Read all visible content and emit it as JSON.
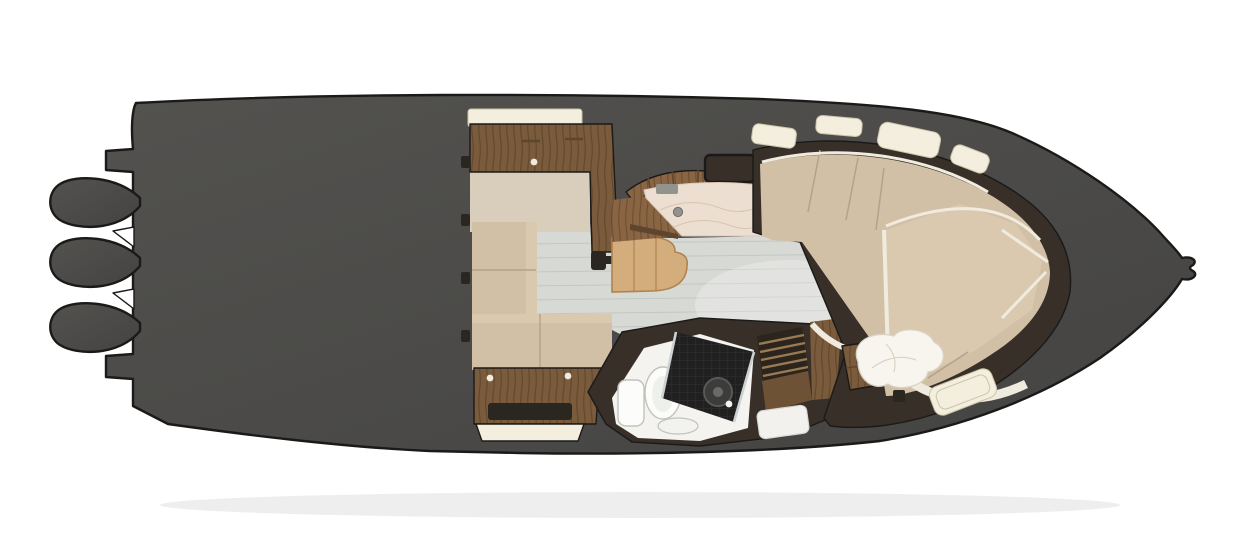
{
  "meta": {
    "diagram_type": "boat-interior-floor-plan-top-view",
    "orientation": "bow-right-stern-left"
  },
  "counts": {
    "engine_pods": 3,
    "top_deck_hatches": 4,
    "bow_lower_hatches": 1,
    "pillows": 2
  },
  "regions": {
    "hull": "boat hull top view",
    "engines": "triple outboard engine pods at stern",
    "salon_cabinet": "salon cabinet with cream counter trim",
    "settee": "L-shaped settee with tan cushions",
    "galley": "galley cabinet with dark sink slot",
    "table": "wood dinette table with pedestal mount",
    "steps": "curved companionway steps",
    "counter": "marble galley countertop with sink and faucet",
    "head": "wet head compartment",
    "toilet": "toilet with tank",
    "shower": "mosaic tile shower floor with drain",
    "grate": "teak shower grate",
    "floor": "cabin sole with plank lines",
    "bow_seating": "wraparound bow seating cushions",
    "berth": "forward berth cushion",
    "pillows": "white berth pillows",
    "hatches": "cream deck hatches",
    "anchor": "anchor roller notch at bow tip"
  },
  "colors": {
    "background": "#ffffff",
    "hull_top": "#53524f",
    "hull_bottom": "#444342",
    "outline": "#1b1a19",
    "shadow": "#cfcfcd",
    "cream": "#f3eedd",
    "cream_edge": "#cbc4a8",
    "wood": "#7a5b3c",
    "wood_dark": "#5e462e",
    "wood_mid": "#8a6543",
    "wood_deep": "#6e5236",
    "table_wood": "#d4ad7d",
    "table_edge": "#b08350",
    "beige_panel": "#d9cebc",
    "beige_inner": "#cfc3ae",
    "cushion": "#d2c0a6",
    "cushion_light": "#dbc9af",
    "cushion_seam": "#b3a288",
    "piping": "#f0ebdf",
    "floor": "#d7d9d5",
    "floor_line": "#b9bdb7",
    "liner": "#372f28",
    "marble": "#ecdfd1",
    "marble_vein": "#c7aa8c",
    "white_room": "#f4f3f0",
    "fixture_fill": "#fcfcfa",
    "fixture_stroke": "#c2c2bd",
    "tile": "#212020",
    "glass": "#ccd2d4",
    "metal": "#93938e",
    "pillow": "#f7f5ee",
    "pillow_line": "#d9d3c4",
    "dark_accent": "#2a2620",
    "slat": "#9a7a52"
  }
}
